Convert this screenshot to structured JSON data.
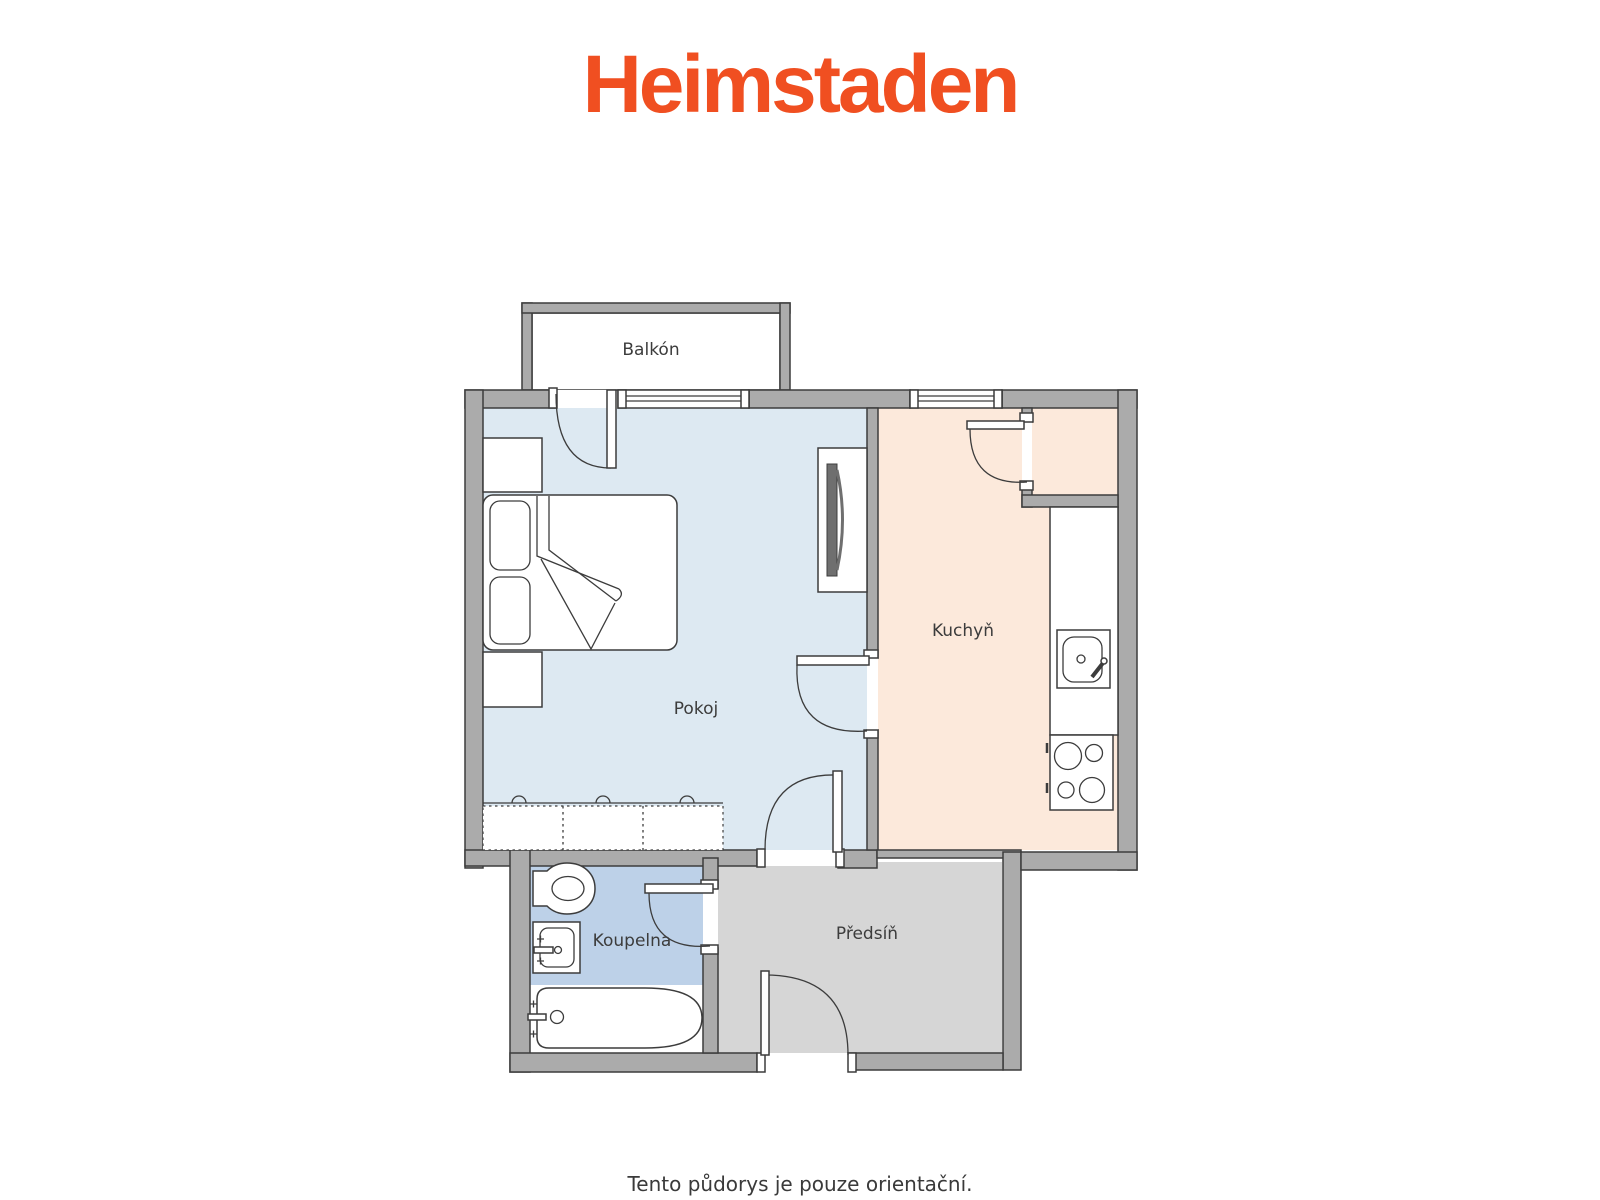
{
  "logo": {
    "text": "Heimstaden",
    "color": "#f04f21"
  },
  "floorplan": {
    "rooms": [
      {
        "id": "balkon",
        "label": "Balkón",
        "fill": "#ffffff"
      },
      {
        "id": "pokoj",
        "label": "Pokoj",
        "fill": "#dde9f2"
      },
      {
        "id": "kuchyn",
        "label": "Kuchyň",
        "fill": "#fce9db"
      },
      {
        "id": "koupelna",
        "label": "Koupelna",
        "fill": "#bdd1e8"
      },
      {
        "id": "predsin",
        "label": "Předsíň",
        "fill": "#d6d6d6"
      }
    ],
    "colors": {
      "wall": "#ababab",
      "line": "#3c3c3c",
      "tv_dark": "#6f6f6f"
    },
    "fixtures": [
      "double-bed",
      "pillow",
      "pillow",
      "nightstand",
      "nightstand",
      "wardrobe",
      "tv-unit",
      "kitchen-counter",
      "kitchen-sink",
      "cooktop",
      "toilet",
      "washbasin",
      "bathtub",
      "balcony-door",
      "window",
      "window",
      "interior-door",
      "interior-door",
      "interior-door",
      "pantry-door",
      "entry-door"
    ]
  },
  "caption": {
    "text": "Tento půdorys je pouze orientační."
  }
}
